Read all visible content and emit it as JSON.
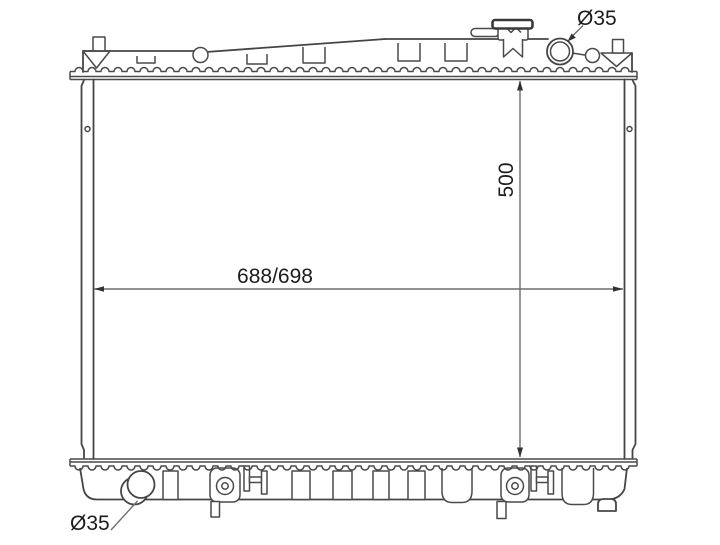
{
  "diagram": {
    "kind": "radiator-engineering-drawing",
    "labels": {
      "top_outlet_diameter": "Ø35",
      "bottom_outlet_diameter": "Ø35",
      "core_height": "500",
      "core_width": "688/698"
    },
    "colors": {
      "line": "#454545",
      "dimension_line": "#6e6e6e",
      "text": "#1c1c1c",
      "background": "#ffffff"
    }
  }
}
